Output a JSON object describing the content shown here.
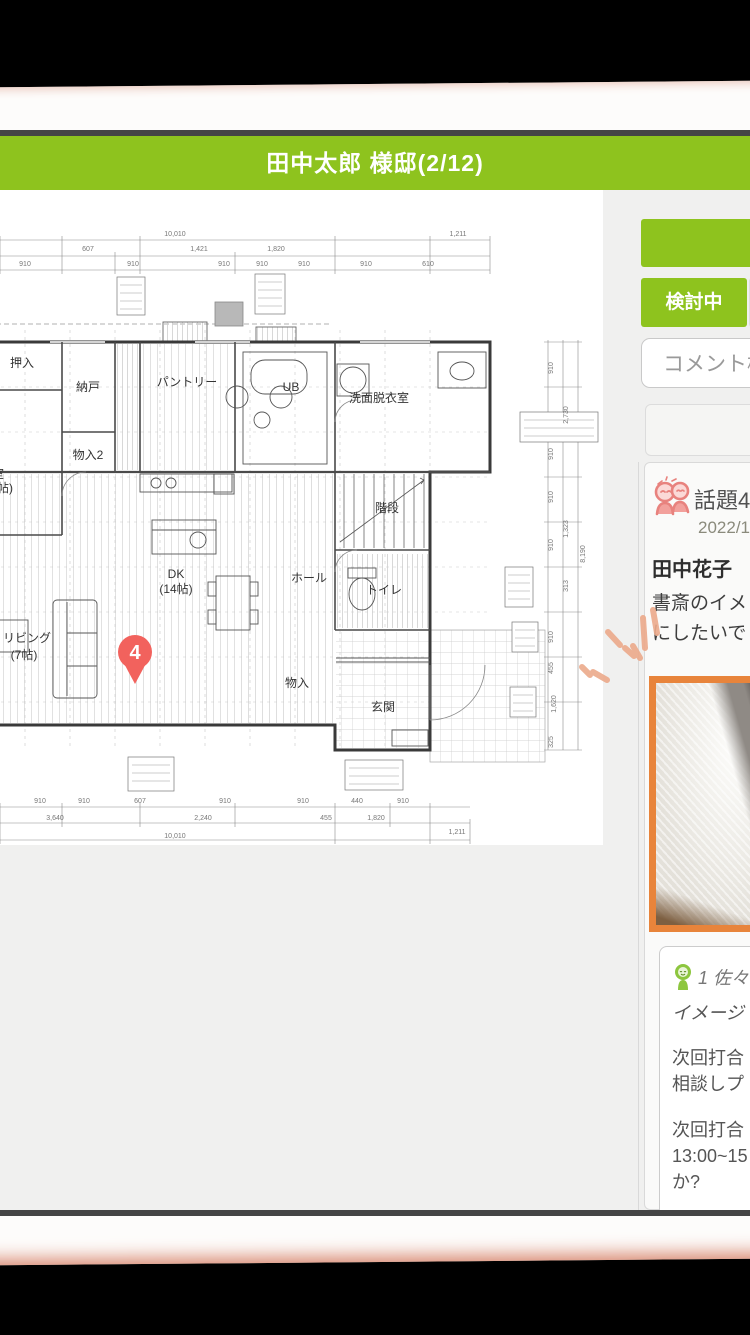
{
  "header": {
    "title": "田中太郎 様邸(2/12)"
  },
  "colors": {
    "green": "#8ec31e",
    "image_border": "#e8843b",
    "pin": "#f2625d",
    "sketch": "#ecaa8b"
  },
  "sidebar": {
    "action_button": {
      "label": ""
    },
    "status_tab": {
      "label": "検討中"
    },
    "search": {
      "placeholder": "コメント検索"
    },
    "topic_card": {
      "icon": "couple-talk-icon",
      "title": "話題4",
      "date": "2022/1",
      "author": "田中花子",
      "message_line1": "書斎のイメ",
      "message_line2": "にしたいで",
      "image": "study-room-photo"
    },
    "reply_card": {
      "icon": "person-icon",
      "header": "1 佐々",
      "line1": "イメージ",
      "para2": [
        "次回打合",
        "相談しプ"
      ],
      "para3": [
        "次回打合",
        "13:00~15",
        "か?"
      ]
    }
  },
  "floorplan": {
    "pin": {
      "number": "4"
    },
    "rooms": [
      {
        "t": "押入",
        "x": 22,
        "y": 177
      },
      {
        "t": "納戸",
        "x": 88,
        "y": 201
      },
      {
        "t": "パントリー",
        "x": 187,
        "y": 196
      },
      {
        "t": "UB",
        "x": 291,
        "y": 201,
        "s": 13
      },
      {
        "t": "洗面脱衣室",
        "x": 379,
        "y": 212
      },
      {
        "t": "物入2",
        "x": 88,
        "y": 269
      },
      {
        "t": "室",
        "x": -2,
        "y": 288
      },
      {
        "t": "(帖)",
        "x": 3,
        "y": 302,
        "s": 9
      },
      {
        "t": "DK",
        "x": 176,
        "y": 388,
        "s": 13
      },
      {
        "t": "(14帖)",
        "x": 176,
        "y": 403,
        "s": 11
      },
      {
        "t": "リビング",
        "x": 27,
        "y": 452
      },
      {
        "t": "(7帖)",
        "x": 24,
        "y": 469,
        "s": 11
      },
      {
        "t": "ホール",
        "x": 309,
        "y": 392
      },
      {
        "t": "階段",
        "x": 387,
        "y": 322
      },
      {
        "t": "トイレ",
        "x": 384,
        "y": 404
      },
      {
        "t": "物入",
        "x": 297,
        "y": 497,
        "s": 9
      },
      {
        "t": "玄関",
        "x": 383,
        "y": 521
      }
    ],
    "dims_top": [
      {
        "t": "10,010",
        "x": 175,
        "y": 46
      },
      {
        "t": "1,211",
        "x": 458,
        "y": 46
      },
      {
        "t": "607",
        "x": 88,
        "y": 61
      },
      {
        "t": "1,421",
        "x": 199,
        "y": 61
      },
      {
        "t": "1,820",
        "x": 276,
        "y": 61
      },
      {
        "t": "910",
        "x": 25,
        "y": 76
      },
      {
        "t": "910",
        "x": 133,
        "y": 76
      },
      {
        "t": "910",
        "x": 224,
        "y": 76
      },
      {
        "t": "910",
        "x": 262,
        "y": 76
      },
      {
        "t": "910",
        "x": 304,
        "y": 76
      },
      {
        "t": "910",
        "x": 366,
        "y": 76
      },
      {
        "t": "610",
        "x": 428,
        "y": 76
      }
    ],
    "dims_bottom": [
      {
        "t": "910",
        "x": 40,
        "y": 613
      },
      {
        "t": "910",
        "x": 84,
        "y": 613
      },
      {
        "t": "607",
        "x": 140,
        "y": 613
      },
      {
        "t": "910",
        "x": 225,
        "y": 613
      },
      {
        "t": "910",
        "x": 303,
        "y": 613
      },
      {
        "t": "440",
        "x": 357,
        "y": 613
      },
      {
        "t": "910",
        "x": 403,
        "y": 613
      },
      {
        "t": "3,640",
        "x": 55,
        "y": 630
      },
      {
        "t": "2,240",
        "x": 203,
        "y": 630
      },
      {
        "t": "455",
        "x": 326,
        "y": 630
      },
      {
        "t": "1,820",
        "x": 376,
        "y": 630
      },
      {
        "t": "10,010",
        "x": 175,
        "y": 648
      },
      {
        "t": "1,211",
        "x": 457,
        "y": 644
      }
    ],
    "dims_right": [
      {
        "t": "910",
        "x": 553,
        "y": 178
      },
      {
        "t": "2,730",
        "x": 568,
        "y": 225
      },
      {
        "t": "910",
        "x": 553,
        "y": 264
      },
      {
        "t": "910",
        "x": 553,
        "y": 307
      },
      {
        "t": "1,323",
        "x": 568,
        "y": 339
      },
      {
        "t": "910",
        "x": 553,
        "y": 355
      },
      {
        "t": "8,190",
        "x": 585,
        "y": 364
      },
      {
        "t": "313",
        "x": 568,
        "y": 396
      },
      {
        "t": "910",
        "x": 553,
        "y": 447
      },
      {
        "t": "455",
        "x": 553,
        "y": 478
      },
      {
        "t": "1,620",
        "x": 556,
        "y": 514
      },
      {
        "t": "325",
        "x": 553,
        "y": 552
      }
    ]
  }
}
